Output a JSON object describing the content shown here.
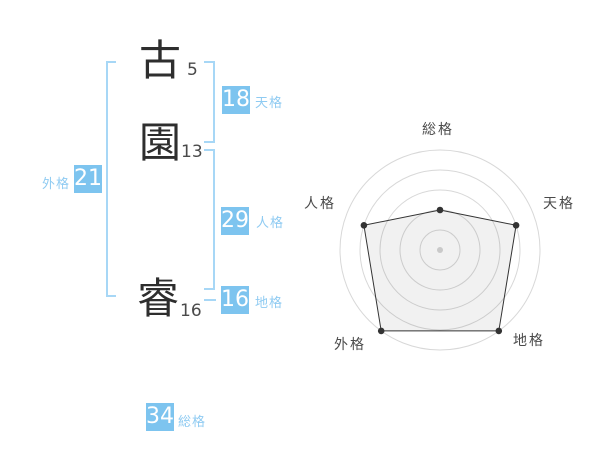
{
  "name_panel": {
    "characters": [
      {
        "char": "古",
        "strokes": "5"
      },
      {
        "char": "園",
        "strokes": "13"
      },
      {
        "char": "睿",
        "strokes": "16"
      }
    ],
    "badges": [
      {
        "id": "tenkaku",
        "value": "18",
        "label": "天格"
      },
      {
        "id": "jinkaku",
        "value": "29",
        "label": "人格"
      },
      {
        "id": "chikaku",
        "value": "16",
        "label": "地格"
      },
      {
        "id": "gaikaku",
        "value": "21",
        "label": "外格"
      },
      {
        "id": "soukaku",
        "value": "34",
        "label": "総格"
      }
    ]
  },
  "colors": {
    "badge_blue": "#7dc4ef",
    "badge_label_blue": "#8fcbf2",
    "bracket_blue": "#a7d7f6",
    "ink": "#2e2e2e",
    "grid_gray": "#d8d8d8"
  },
  "chart_data": {
    "type": "radar",
    "axes": [
      "総格",
      "天格",
      "地格",
      "外格",
      "人格"
    ],
    "values": [
      40,
      80,
      100,
      100,
      80
    ],
    "max": 100,
    "rings": [
      20,
      40,
      60,
      80,
      100
    ],
    "start_angle_deg": -90,
    "direction": "clockwise",
    "grid": "circular",
    "legend": "none",
    "center_dot": true,
    "colors": {
      "polygon_stroke": "#333333",
      "polygon_fill": "rgba(0,0,0,0.055)",
      "grid": "#d8d8d8",
      "point": "#333333",
      "center_dot": "#c9c9c9",
      "label": "#4a4a4a"
    }
  }
}
